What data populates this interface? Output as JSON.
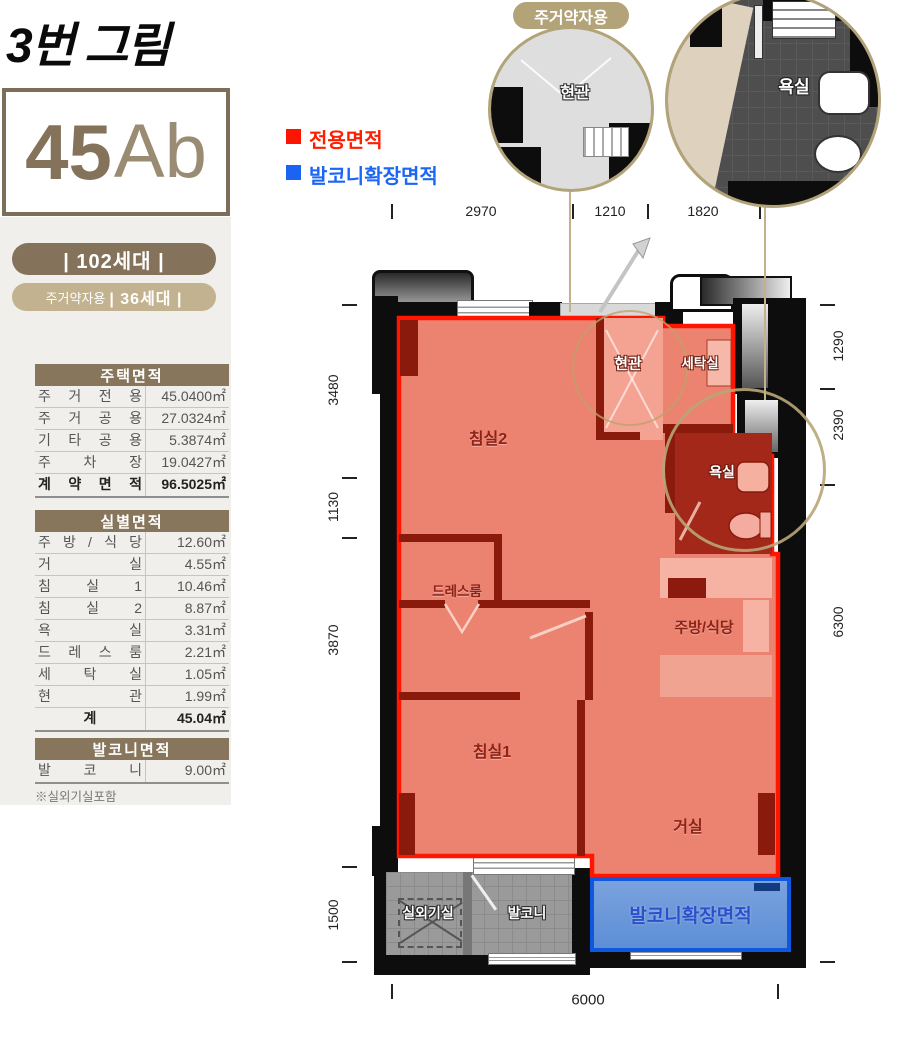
{
  "header": {
    "figure_label": "3번 그림"
  },
  "unit": {
    "number": "45",
    "suffix": "Ab",
    "households": "| 102세대 |",
    "special_prefix": "주거약자용",
    "special_households": "| 36세대 |"
  },
  "legend": {
    "exclusive_label": "전용면적",
    "balcony_ext_label": "발코니확장면적"
  },
  "tables": {
    "housing": {
      "title": "주택면적",
      "rows": [
        {
          "label": "주 거 전 용",
          "value": "45.0400㎡"
        },
        {
          "label": "주 거 공 용",
          "value": "27.0324㎡"
        },
        {
          "label": "기 타 공 용",
          "value": "5.3874㎡"
        },
        {
          "label": "주 차 장",
          "value": "19.0427㎡"
        }
      ],
      "total": {
        "label": "계 약 면 적",
        "value": "96.5025㎡"
      }
    },
    "rooms": {
      "title": "실별면적",
      "rows": [
        {
          "label": "주 방 / 식 당",
          "value": "12.60㎡"
        },
        {
          "label": "거 실",
          "value": "4.55㎡"
        },
        {
          "label": "침 실 1",
          "value": "10.46㎡"
        },
        {
          "label": "침 실 2",
          "value": "8.87㎡"
        },
        {
          "label": "욕 실",
          "value": "3.31㎡"
        },
        {
          "label": "드 레 스 룸",
          "value": "2.21㎡"
        },
        {
          "label": "세 탁 실",
          "value": "1.05㎡"
        },
        {
          "label": "현 관",
          "value": "1.99㎡"
        }
      ],
      "total": {
        "label": "계",
        "value": "45.04㎡"
      }
    },
    "balcony": {
      "title": "발코니면적",
      "rows": [
        {
          "label": "발 코 니",
          "value": "9.00㎡"
        }
      ]
    },
    "footnote": "※실외기실포함"
  },
  "callouts": {
    "tag": "주거약자용",
    "entrance_label": "현관",
    "bath_label": "욕실"
  },
  "plan": {
    "bedroom2": "침실2",
    "entrance": "현관",
    "laundry": "세탁실",
    "bath": "욕실",
    "dressroom": "드레스룸",
    "kitchen": "주방/식당",
    "bedroom1": "침실1",
    "living": "거실",
    "outdoor_unit": "실외기실",
    "balcony": "발코니",
    "balcony_ext": "발코니확장면적"
  },
  "dimensions": {
    "top": [
      "2970",
      "1210",
      "1820"
    ],
    "left": [
      "3480",
      "1130",
      "3870",
      "1500"
    ],
    "right": [
      "1290",
      "2390",
      "6300"
    ],
    "bottom": [
      "6000"
    ]
  },
  "colors": {
    "accent_brown": "#87765c",
    "accent_tan": "#c3b28f",
    "exclusive_red": "#ff1400",
    "balcony_blue": "#1057e0"
  }
}
